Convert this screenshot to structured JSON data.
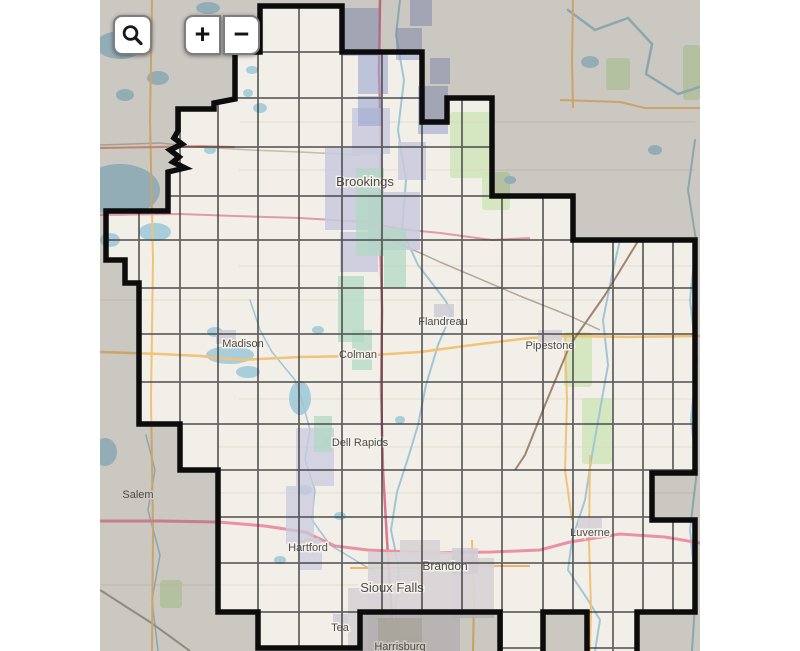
{
  "map": {
    "x": 100,
    "width": 600,
    "height": 651,
    "land_color": "#f2efe9",
    "mask_color": "rgba(62,60,52,0.22)",
    "boundary_color": "#0c0c0c",
    "boundary_width": 5.5,
    "grid_color": "#3d3d3d",
    "grid_width": 1.8,
    "grid_opacity": 0.78,
    "water_color": "#a9cedb",
    "river_color": "#9fc6d5"
  },
  "controls": {
    "search_icon": "magnifier",
    "zoom_in_label": "+",
    "zoom_out_label": "−"
  },
  "boundary_points": "160,6 242,6 242,52 322,52 322,122 347,122 347,98 392,98 392,196 473,196 473,240 595,240 595,473 552,473 552,520 595,520 595,612 537,612 537,662 487,662 487,612 443,612 443,662 400,662 400,612 260,612 260,648 158,648 158,612 118,612 118,470 80,470 80,424 39,424 39,283 25,283 25,260 6,260 6,211 68,211 68,172 85,168 73,162 79,157 70,150 82,144 74,138 78,131 78,109 114,109 114,103 135,99 135,52 160,52",
  "grid": {
    "xs": [
      39,
      80,
      118,
      158,
      199,
      242,
      282,
      322,
      362,
      402,
      443,
      473,
      513,
      543,
      573
    ],
    "ys": [
      52,
      98,
      147,
      196,
      240,
      288,
      334,
      382,
      424,
      470,
      517,
      563,
      612,
      648
    ]
  },
  "minor_roads": [
    {
      "p": "140,122 595,122"
    },
    {
      "p": "139,170 595,170"
    },
    {
      "p": "139,266 595,266"
    },
    {
      "p": "0,300 595,300"
    },
    {
      "p": "139,399 595,399"
    },
    {
      "p": "118,447 595,447"
    },
    {
      "p": "118,493 595,493"
    },
    {
      "p": "0,585 258,585"
    }
  ],
  "greens": [
    [
      350,
      112,
      42,
      66
    ],
    [
      382,
      172,
      28,
      38
    ],
    [
      464,
      332,
      28,
      55
    ],
    [
      482,
      398,
      30,
      66
    ],
    [
      583,
      45,
      17,
      55
    ],
    [
      506,
      58,
      24,
      32
    ],
    [
      60,
      580,
      22,
      28
    ],
    [
      300,
      635,
      25,
      16
    ]
  ],
  "lakes": [
    [
      20,
      45,
      24,
      14
    ],
    [
      58,
      78,
      11,
      7
    ],
    [
      25,
      95,
      9,
      6
    ],
    [
      95,
      30,
      8,
      5
    ],
    [
      140,
      42,
      7,
      5
    ],
    [
      152,
      70,
      6,
      4
    ],
    [
      160,
      108,
      7,
      5
    ],
    [
      148,
      93,
      5,
      4
    ],
    [
      110,
      150,
      6,
      4
    ],
    [
      20,
      190,
      40,
      26
    ],
    [
      55,
      232,
      16,
      9
    ],
    [
      10,
      240,
      10,
      7
    ],
    [
      130,
      355,
      24,
      9
    ],
    [
      148,
      372,
      12,
      6
    ],
    [
      200,
      398,
      11,
      17
    ],
    [
      115,
      332,
      8,
      5
    ],
    [
      218,
      330,
      6,
      4
    ],
    [
      230,
      442,
      6,
      4
    ],
    [
      205,
      490,
      7,
      5
    ],
    [
      240,
      516,
      6,
      4
    ],
    [
      490,
      62,
      9,
      6
    ],
    [
      555,
      150,
      7,
      5
    ],
    [
      410,
      180,
      6,
      4
    ],
    [
      300,
      420,
      5,
      4
    ],
    [
      180,
      560,
      6,
      4
    ],
    [
      108,
      8,
      12,
      6
    ],
    [
      5,
      452,
      12,
      14
    ]
  ],
  "rivers": [
    {
      "p": "300,0 296,35 304,80 298,130 306,180 302,230 318,265 345,300 352,312 338,345 326,385 318,425 309,455 297,492 291,530 299,568 295,612 304,651",
      "w": 2
    },
    {
      "p": "468,10 495,30 528,18 552,44 546,74 578,94 615,82 645,114 672,102 695,130",
      "w": 2.5
    },
    {
      "p": "595,140 588,190 596,240 590,300 597,360 591,420 597,470 590,530 596,590 592,651",
      "w": 2
    },
    {
      "p": "520,240 512,275 503,320 508,365 500,410 492,455 485,500 472,540 468,570 488,600 500,620 495,651",
      "w": 2
    },
    {
      "p": "46,435 55,470 48,510 60,555 52,600 58,651",
      "w": 1.5
    },
    {
      "p": "150,300 160,330 172,352 195,380 202,400 210,430 205,460 215,490 212,520 230,545 255,560 275,572",
      "w": 1.5
    }
  ],
  "roads": [
    {
      "p": "0,145 60,143 100,147 150,150 200,152 260,155",
      "c": "#c2bbae",
      "w": 1.5
    },
    {
      "p": "285,237 340,262 420,296 470,316 500,330",
      "c": "#b3a89a",
      "w": 1.5
    },
    {
      "p": "0,590 50,622 90,651",
      "c": "#a89f92",
      "w": 2
    },
    {
      "p": "52,0 50,120 53,260 51,400 53,530 52,651",
      "c": "#f2c276",
      "w": 2
    },
    {
      "p": "460,100 520,102 545,108 600,108",
      "c": "#f2c276",
      "w": 2
    },
    {
      "p": "473,0 472,60 473,108",
      "c": "#f2c276",
      "w": 2
    },
    {
      "p": "465,336 467,400 465,470 472,520",
      "c": "#f2c276",
      "w": 2
    },
    {
      "p": "490,455 489,540 491,610 490,651",
      "c": "#f2c276",
      "w": 2
    },
    {
      "p": "0,352 60,354 100,356 140,360 200,357 258,356 320,352 380,344 430,338 470,336 530,337 600,336",
      "c": "#f2c276",
      "w": 2.5
    },
    {
      "p": "320,545 321,600 320,651",
      "c": "#f0c060",
      "w": 2
    },
    {
      "p": "372,540 374,600 373,651",
      "c": "#f0c060",
      "w": 2
    },
    {
      "p": "250,568 320,568 390,566 430,566",
      "c": "#f0b46a",
      "w": 2
    },
    {
      "p": "540,238 505,295 470,345 445,405 425,455 415,470",
      "c": "#a2846e",
      "w": 2
    },
    {
      "p": "0,148 60,147 100,146 135,147",
      "c": "#e8967f",
      "w": 2
    },
    {
      "p": "0,215 80,214 135,216 200,218 265,222 300,229 340,233 392,240 430,238",
      "c": "#e09aa8",
      "w": 2
    },
    {
      "p": "280,0 279,70 281,150 280,230 282,310 281,390 283,470 287,540 291,600 293,651",
      "c": "#d9778e",
      "w": 2.5
    },
    {
      "p": "0,521 60,521 118,522 165,526 205,532 235,546 268,550 330,553 392,552 440,550 470,542 520,534 565,537 600,543",
      "c": "#ec91a4",
      "w": 3
    }
  ],
  "urban": [
    [
      225,
      148,
      58,
      82,
      "#c9c9de",
      0.85
    ],
    [
      252,
      108,
      38,
      46,
      "#c9c9de",
      0.85
    ],
    [
      268,
      192,
      52,
      58,
      "#c9c9de",
      0.85
    ],
    [
      240,
      232,
      38,
      40,
      "#c9c9de",
      0.85
    ],
    [
      298,
      142,
      28,
      38,
      "#c9c9de",
      0.85
    ],
    [
      243,
      8,
      36,
      48,
      "#9aa5cf",
      0.6
    ],
    [
      258,
      52,
      30,
      42,
      "#9aa5cf",
      0.6
    ],
    [
      296,
      28,
      26,
      32,
      "#9aa5cf",
      0.6
    ],
    [
      318,
      86,
      30,
      48,
      "#9aa5cf",
      0.6
    ],
    [
      330,
      58,
      20,
      26,
      "#9aa5cf",
      0.6
    ],
    [
      258,
      96,
      24,
      30,
      "#9aa5cf",
      0.6
    ],
    [
      310,
      0,
      22,
      26,
      "#9aa5cf",
      0.6
    ],
    [
      256,
      168,
      28,
      88,
      "#aed8c0",
      0.7
    ],
    [
      284,
      228,
      22,
      60,
      "#aed8c0",
      0.7
    ],
    [
      238,
      276,
      26,
      66,
      "#aed8c0",
      0.7
    ],
    [
      252,
      330,
      20,
      40,
      "#aed8c0",
      0.7
    ],
    [
      196,
      428,
      38,
      58,
      "#c9c9de",
      0.75
    ],
    [
      186,
      486,
      28,
      58,
      "#c9c9de",
      0.75
    ],
    [
      214,
      416,
      18,
      36,
      "#aed8c0",
      0.7
    ],
    [
      200,
      540,
      22,
      30,
      "#c9c9de",
      0.7
    ],
    [
      268,
      552,
      92,
      99,
      "#d7d3d6",
      0.9
    ],
    [
      248,
      588,
      42,
      63,
      "#d7d3d6",
      0.9
    ],
    [
      352,
      558,
      42,
      60,
      "#d7d3d6",
      0.9
    ],
    [
      300,
      540,
      40,
      20,
      "#d7d3d6",
      0.9
    ],
    [
      352,
      548,
      26,
      26,
      "#d2cdd6",
      0.9
    ],
    [
      438,
      330,
      24,
      20,
      "#d5d0d8",
      0.9
    ],
    [
      478,
      518,
      24,
      18,
      "#d5d0d8",
      0.9
    ],
    [
      116,
      330,
      20,
      14,
      "#d2cdd6",
      0.9
    ],
    [
      204,
      538,
      15,
      13,
      "#d2cdd6",
      0.9
    ],
    [
      334,
      304,
      20,
      13,
      "#d2cdd6",
      0.9
    ],
    [
      233,
      614,
      15,
      15,
      "#d2cdd6",
      0.9
    ],
    [
      278,
      618,
      44,
      33,
      "#c6c2ba",
      0.9
    ]
  ],
  "labels": [
    {
      "t": "Brookings",
      "x": 265,
      "y": 186,
      "s": 13
    },
    {
      "t": "Madison",
      "x": 143,
      "y": 347,
      "s": 11
    },
    {
      "t": "Colman",
      "x": 258,
      "y": 358,
      "s": 11
    },
    {
      "t": "Flandreau",
      "x": 343,
      "y": 325,
      "s": 11
    },
    {
      "t": "Pipestone",
      "x": 450,
      "y": 349,
      "s": 11
    },
    {
      "t": "Dell Rapids",
      "x": 260,
      "y": 446,
      "s": 11
    },
    {
      "t": "Salem",
      "x": 38,
      "y": 498,
      "s": 11
    },
    {
      "t": "Hartford",
      "x": 208,
      "y": 551,
      "s": 11
    },
    {
      "t": "Brandon",
      "x": 345,
      "y": 570,
      "s": 12
    },
    {
      "t": "Sioux Falls",
      "x": 292,
      "y": 592,
      "s": 13
    },
    {
      "t": "Luverne",
      "x": 490,
      "y": 536,
      "s": 11
    },
    {
      "t": "Tea",
      "x": 240,
      "y": 631,
      "s": 11
    },
    {
      "t": "Harrisburg",
      "x": 300,
      "y": 650,
      "s": 11
    }
  ]
}
